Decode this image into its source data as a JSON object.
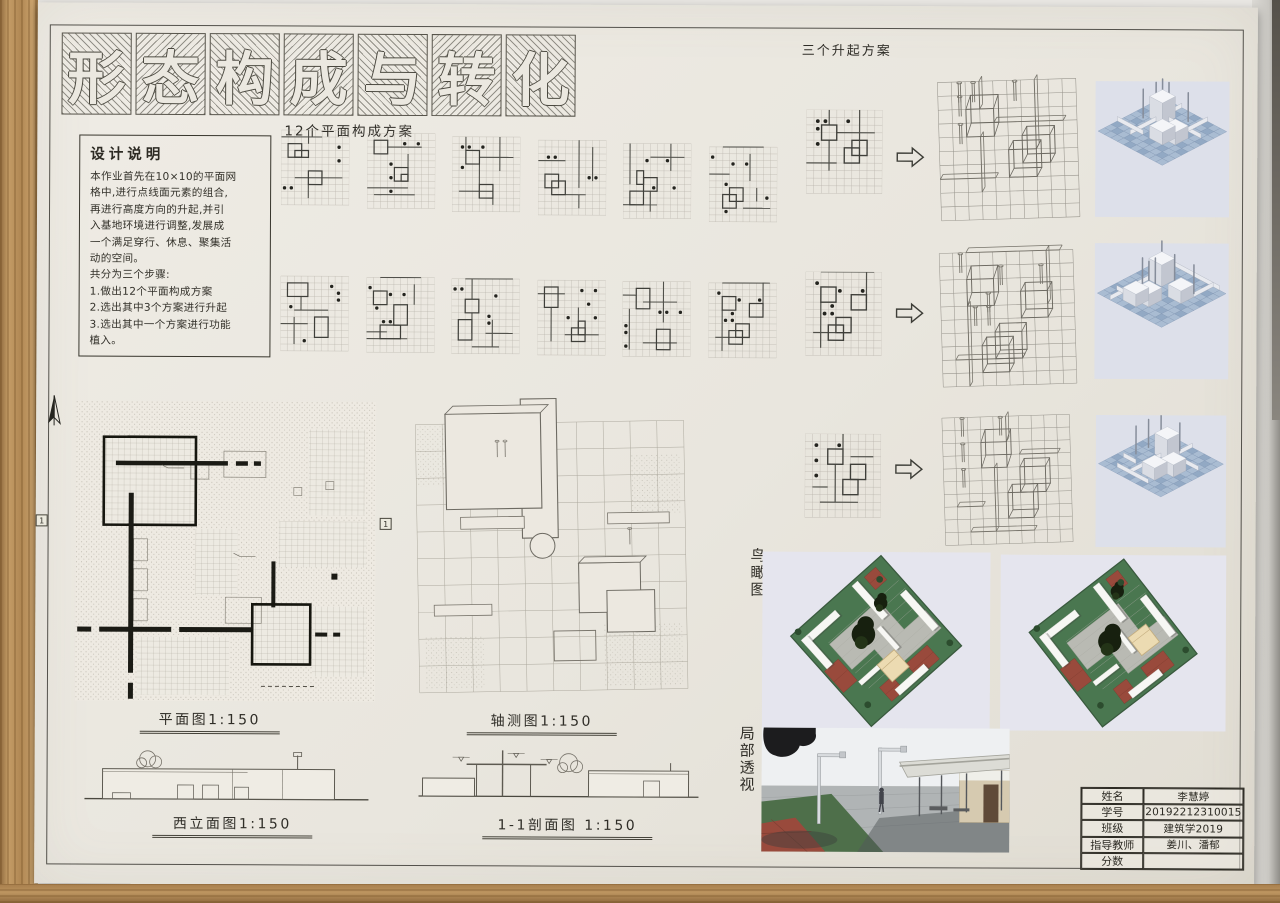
{
  "title": {
    "text": "形态构成与转化",
    "chars": [
      "形",
      "态",
      "构",
      "成",
      "与",
      "转",
      "化"
    ]
  },
  "design_notes": {
    "title": "设计说明",
    "lines": [
      "本作业首先在10×10的平面网",
      "格中,进行点线面元素的组合,",
      "再进行高度方向的升起,并引",
      "入基地环境进行调整,发展成",
      "一个满足穿行、休息、聚集活",
      "动的空间。",
      "共分为三个步骤:",
      "1.做出12个平面构成方案",
      "2.选出其中3个方案进行升起",
      "3.选出其中一个方案进行功能",
      "   植入。"
    ]
  },
  "labels": {
    "plans": "12个平面构成方案",
    "rising": "三个升起方案",
    "plan": "平面图1:150",
    "axon": "轴测图1:150",
    "west_elevation": "西立面图1:150",
    "section": "1-1剖面图 1:150",
    "birdseye": "鸟瞰图",
    "perspective": "局部透视",
    "section_marker": "1"
  },
  "title_block": {
    "rows": [
      {
        "label": "姓名",
        "value": "李慧婷"
      },
      {
        "label": "学号",
        "value": "20192212310015"
      },
      {
        "label": "班级",
        "value": "建筑学2019"
      },
      {
        "label": "指导教师",
        "value": "姜川、潘郁"
      },
      {
        "label": "分数",
        "value": ""
      }
    ]
  },
  "schemes": {
    "row1": [
      {
        "d": [
          [
            8,
            2
          ],
          [
            8,
            4
          ],
          [
            0,
            8
          ],
          [
            1,
            8
          ]
        ],
        "r": [
          [
            1,
            2,
            2,
            2
          ],
          [
            2,
            3,
            2,
            1
          ],
          [
            4,
            6,
            2,
            2
          ]
        ],
        "l": [
          [
            0,
            1,
            6,
            1
          ],
          [
            2,
            7,
            9,
            7
          ],
          [
            4,
            0,
            4,
            2
          ],
          [
            4,
            8,
            4,
            10
          ],
          [
            6,
            6,
            6,
            8
          ]
        ]
      },
      {
        "d": [
          [
            5,
            1
          ],
          [
            7,
            1
          ],
          [
            3,
            4
          ],
          [
            3,
            6
          ],
          [
            3,
            8
          ]
        ],
        "r": [
          [
            1,
            1,
            2,
            2
          ],
          [
            4,
            5,
            2,
            2
          ],
          [
            5,
            6,
            1,
            1
          ]
        ],
        "l": [
          [
            3,
            2,
            8,
            2
          ],
          [
            0,
            8,
            6,
            8
          ],
          [
            1,
            9,
            7,
            9
          ],
          [
            6,
            3,
            6,
            5
          ]
        ]
      },
      {
        "d": [
          [
            1,
            1
          ],
          [
            2,
            1
          ],
          [
            4,
            1
          ],
          [
            1,
            4
          ]
        ],
        "r": [
          [
            2,
            2,
            2,
            2
          ],
          [
            4,
            7,
            2,
            2
          ]
        ],
        "l": [
          [
            4,
            3,
            9,
            3
          ],
          [
            7,
            0,
            7,
            5
          ],
          [
            2,
            0,
            2,
            2
          ],
          [
            1,
            8,
            6,
            8
          ],
          [
            4,
            4,
            4,
            7
          ],
          [
            6,
            9,
            6,
            10
          ]
        ]
      },
      {
        "d": [
          [
            1,
            2
          ],
          [
            2,
            2
          ],
          [
            7,
            5
          ],
          [
            8,
            5
          ]
        ],
        "r": [
          [
            1,
            5,
            2,
            2
          ],
          [
            2,
            6,
            2,
            2
          ]
        ],
        "l": [
          [
            6,
            0,
            6,
            7
          ],
          [
            8,
            1,
            8,
            6
          ],
          [
            0,
            3,
            4,
            3
          ],
          [
            2,
            8,
            7,
            8
          ],
          [
            6,
            8,
            6,
            10
          ]
        ]
      },
      {
        "d": [
          [
            4,
            6
          ],
          [
            6,
            2
          ],
          [
            7,
            6
          ],
          [
            3,
            2
          ]
        ],
        "r": [
          [
            2,
            4,
            1,
            2
          ],
          [
            3,
            5,
            2,
            2
          ],
          [
            1,
            7,
            2,
            2
          ]
        ],
        "l": [
          [
            1,
            0,
            1,
            6
          ],
          [
            4,
            2,
            9,
            2
          ],
          [
            7,
            0,
            7,
            4
          ],
          [
            0,
            9,
            5,
            9
          ],
          [
            4,
            7,
            4,
            10
          ]
        ]
      },
      {
        "d": [
          [
            0,
            1
          ],
          [
            3,
            2
          ],
          [
            5,
            2
          ],
          [
            2,
            5
          ],
          [
            2,
            9
          ],
          [
            8,
            7
          ]
        ],
        "r": [
          [
            3,
            6,
            2,
            2
          ],
          [
            2,
            7,
            2,
            2
          ]
        ],
        "l": [
          [
            2,
            0,
            8,
            0
          ],
          [
            6,
            1,
            6,
            5
          ],
          [
            0,
            4,
            3,
            4
          ],
          [
            5,
            9,
            9,
            9
          ],
          [
            7,
            6,
            7,
            8
          ]
        ]
      }
    ],
    "row2": [
      {
        "d": [
          [
            7,
            1
          ],
          [
            8,
            2
          ],
          [
            8,
            3
          ],
          [
            1,
            4
          ],
          [
            3,
            9
          ]
        ],
        "r": [
          [
            1,
            1,
            3,
            2
          ],
          [
            5,
            6,
            2,
            3
          ]
        ],
        "l": [
          [
            3,
            3,
            3,
            5
          ],
          [
            2,
            5,
            7,
            5
          ],
          [
            0,
            7,
            4,
            7
          ],
          [
            2,
            6,
            2,
            10
          ]
        ]
      },
      {
        "d": [
          [
            0,
            1
          ],
          [
            3,
            2
          ],
          [
            5,
            2
          ],
          [
            1,
            4
          ],
          [
            2,
            6
          ],
          [
            3,
            6
          ]
        ],
        "r": [
          [
            1,
            2,
            2,
            2
          ],
          [
            4,
            4,
            2,
            3
          ],
          [
            2,
            7,
            3,
            2
          ]
        ],
        "l": [
          [
            2,
            0,
            8,
            0
          ],
          [
            7,
            1,
            7,
            4
          ],
          [
            0,
            8,
            3,
            8
          ],
          [
            0,
            9,
            6,
            9
          ]
        ]
      },
      {
        "d": [
          [
            0,
            1
          ],
          [
            1,
            1
          ],
          [
            6,
            2
          ],
          [
            5,
            5
          ],
          [
            5,
            6
          ]
        ],
        "r": [
          [
            2,
            3,
            2,
            2
          ],
          [
            1,
            6,
            2,
            3
          ]
        ],
        "l": [
          [
            2,
            0,
            9,
            0
          ],
          [
            3,
            0,
            3,
            3
          ],
          [
            3,
            5,
            3,
            8
          ],
          [
            6,
            6,
            6,
            10
          ],
          [
            5,
            8,
            9,
            8
          ],
          [
            3,
            10,
            7,
            10
          ]
        ]
      },
      {
        "d": [
          [
            6,
            1
          ],
          [
            8,
            1
          ],
          [
            7,
            3
          ],
          [
            4,
            5
          ],
          [
            8,
            5
          ]
        ],
        "r": [
          [
            1,
            1,
            2,
            3
          ],
          [
            5,
            7,
            2,
            2
          ],
          [
            6,
            6,
            1,
            2
          ]
        ],
        "l": [
          [
            0,
            2,
            4,
            2
          ],
          [
            2,
            4,
            2,
            9
          ],
          [
            4,
            8,
            9,
            8
          ],
          [
            6,
            4,
            6,
            7
          ]
        ]
      },
      {
        "d": [
          [
            5,
            4
          ],
          [
            6,
            4
          ],
          [
            8,
            4
          ],
          [
            0,
            6
          ],
          [
            0,
            7
          ],
          [
            0,
            9
          ]
        ],
        "r": [
          [
            2,
            1,
            2,
            3
          ],
          [
            5,
            7,
            2,
            3
          ]
        ],
        "l": [
          [
            6,
            0,
            6,
            6
          ],
          [
            3,
            3,
            8,
            3
          ],
          [
            1,
            4,
            1,
            10
          ],
          [
            3,
            9,
            8,
            9
          ],
          [
            0,
            2,
            2,
            2
          ]
        ]
      },
      {
        "d": [
          [
            1,
            1
          ],
          [
            4,
            2
          ],
          [
            7,
            2
          ],
          [
            3,
            4
          ],
          [
            2,
            5
          ],
          [
            3,
            5
          ]
        ],
        "r": [
          [
            2,
            2,
            2,
            2
          ],
          [
            6,
            3,
            2,
            2
          ],
          [
            4,
            6,
            2,
            2
          ],
          [
            3,
            7,
            2,
            2
          ]
        ],
        "l": [
          [
            2,
            0,
            9,
            0
          ],
          [
            8,
            0,
            8,
            4
          ],
          [
            1,
            8,
            6,
            8
          ],
          [
            2,
            4,
            2,
            10
          ]
        ]
      }
    ],
    "selected": [
      {
        "d": [
          [
            1,
            1
          ],
          [
            2,
            1
          ],
          [
            5,
            1
          ],
          [
            1,
            2
          ],
          [
            1,
            4
          ]
        ],
        "r": [
          [
            2,
            2,
            2,
            2
          ],
          [
            6,
            4,
            2,
            2
          ],
          [
            5,
            5,
            2,
            2
          ]
        ],
        "l": [
          [
            3,
            0,
            3,
            2
          ],
          [
            4,
            3,
            9,
            3
          ],
          [
            7,
            0,
            7,
            5
          ],
          [
            3,
            4,
            3,
            8
          ],
          [
            0,
            7,
            4,
            7
          ]
        ]
      },
      {
        "d": [
          [
            1,
            1
          ],
          [
            4,
            2
          ],
          [
            7,
            2
          ],
          [
            3,
            4
          ],
          [
            2,
            5
          ],
          [
            3,
            5
          ]
        ],
        "r": [
          [
            2,
            2,
            2,
            2
          ],
          [
            6,
            3,
            2,
            2
          ],
          [
            4,
            6,
            2,
            2
          ],
          [
            3,
            7,
            2,
            2
          ]
        ],
        "l": [
          [
            2,
            0,
            9,
            0
          ],
          [
            8,
            0,
            8,
            4
          ],
          [
            1,
            8,
            6,
            8
          ],
          [
            2,
            4,
            2,
            10
          ]
        ]
      },
      {
        "d": [
          [
            1,
            1
          ],
          [
            1,
            3
          ],
          [
            1,
            5
          ],
          [
            4,
            1
          ]
        ],
        "r": [
          [
            3,
            2,
            2,
            2
          ],
          [
            6,
            4,
            2,
            2
          ],
          [
            5,
            6,
            2,
            2
          ]
        ],
        "l": [
          [
            5,
            0,
            5,
            2
          ],
          [
            6,
            3,
            9,
            3
          ],
          [
            4,
            4,
            4,
            9
          ],
          [
            1,
            7,
            3,
            7
          ],
          [
            2,
            9,
            7,
            9
          ]
        ]
      }
    ]
  },
  "colors": {
    "paper": "#e9e6de",
    "ink": "#3a382f",
    "grid": "#b7b3aa",
    "render_bg": "#dde0ea",
    "tile": "#a9bcd2",
    "tile_dark": "#92a9c4",
    "tile_edge": "#7e94b1",
    "site_green": "#4a7750",
    "paving": "#b9bab3",
    "tile_red": "#994a3c",
    "tan": "#ecdbb2",
    "tree": "#17200f",
    "sky": "#eef0f2",
    "ground": "#b0b4b5"
  }
}
